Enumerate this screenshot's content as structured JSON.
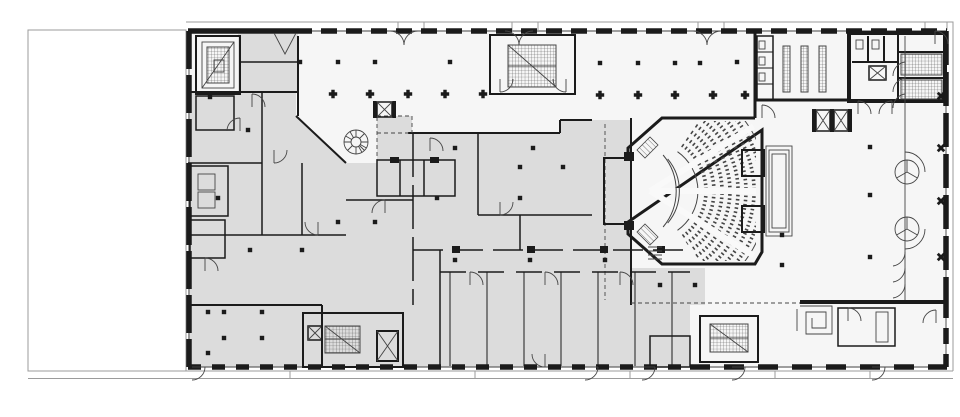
{
  "document": {
    "kind": "architectural-floor-plan",
    "view": "ground-floor-plan",
    "visible_text": []
  },
  "palette": {
    "background": "#ffffff",
    "open_floor": "#f6f6f6",
    "room_poche": "#dcdcdc",
    "wall": "#1b1b1b",
    "thin_line": "#454545",
    "site_line": "#9b9b9b",
    "core_white": "#ffffff"
  },
  "plan": {
    "zones": [
      {
        "id": "vacant-lot-west",
        "fill": "background"
      },
      {
        "id": "offices-west",
        "fill": "room_poche"
      },
      {
        "id": "open-column-hall",
        "fill": "open_floor"
      },
      {
        "id": "offices-south",
        "fill": "room_poche"
      },
      {
        "id": "auditorium",
        "fill": "open_floor"
      },
      {
        "id": "atrium-east",
        "fill": "open_floor"
      },
      {
        "id": "service-core-northeast",
        "fill": "core_white"
      },
      {
        "id": "rooms-southeast",
        "fill": "open_floor"
      }
    ],
    "features": [
      {
        "id": "revolving-door",
        "count": 2
      },
      {
        "id": "elevator-x-box",
        "count": 6
      },
      {
        "id": "straight-stair-hatched",
        "count": 6
      },
      {
        "id": "spiral-stair",
        "count": 1
      },
      {
        "id": "winder-stair-northwest",
        "count": 1
      },
      {
        "id": "auditorium-seating-rows",
        "count": 10
      },
      {
        "id": "stage-platform-arc",
        "count": 1
      },
      {
        "id": "projection-booths",
        "count": 2
      },
      {
        "id": "locker-bars",
        "count": 3
      },
      {
        "id": "square-spiral-desk",
        "count": 1
      },
      {
        "id": "column-square",
        "count": 48
      },
      {
        "id": "column-cross",
        "count": 10
      },
      {
        "id": "column-star-arcade",
        "count": 4
      },
      {
        "id": "door-swing",
        "count": 30
      },
      {
        "id": "sidewalk-band",
        "count": 1
      }
    ]
  }
}
